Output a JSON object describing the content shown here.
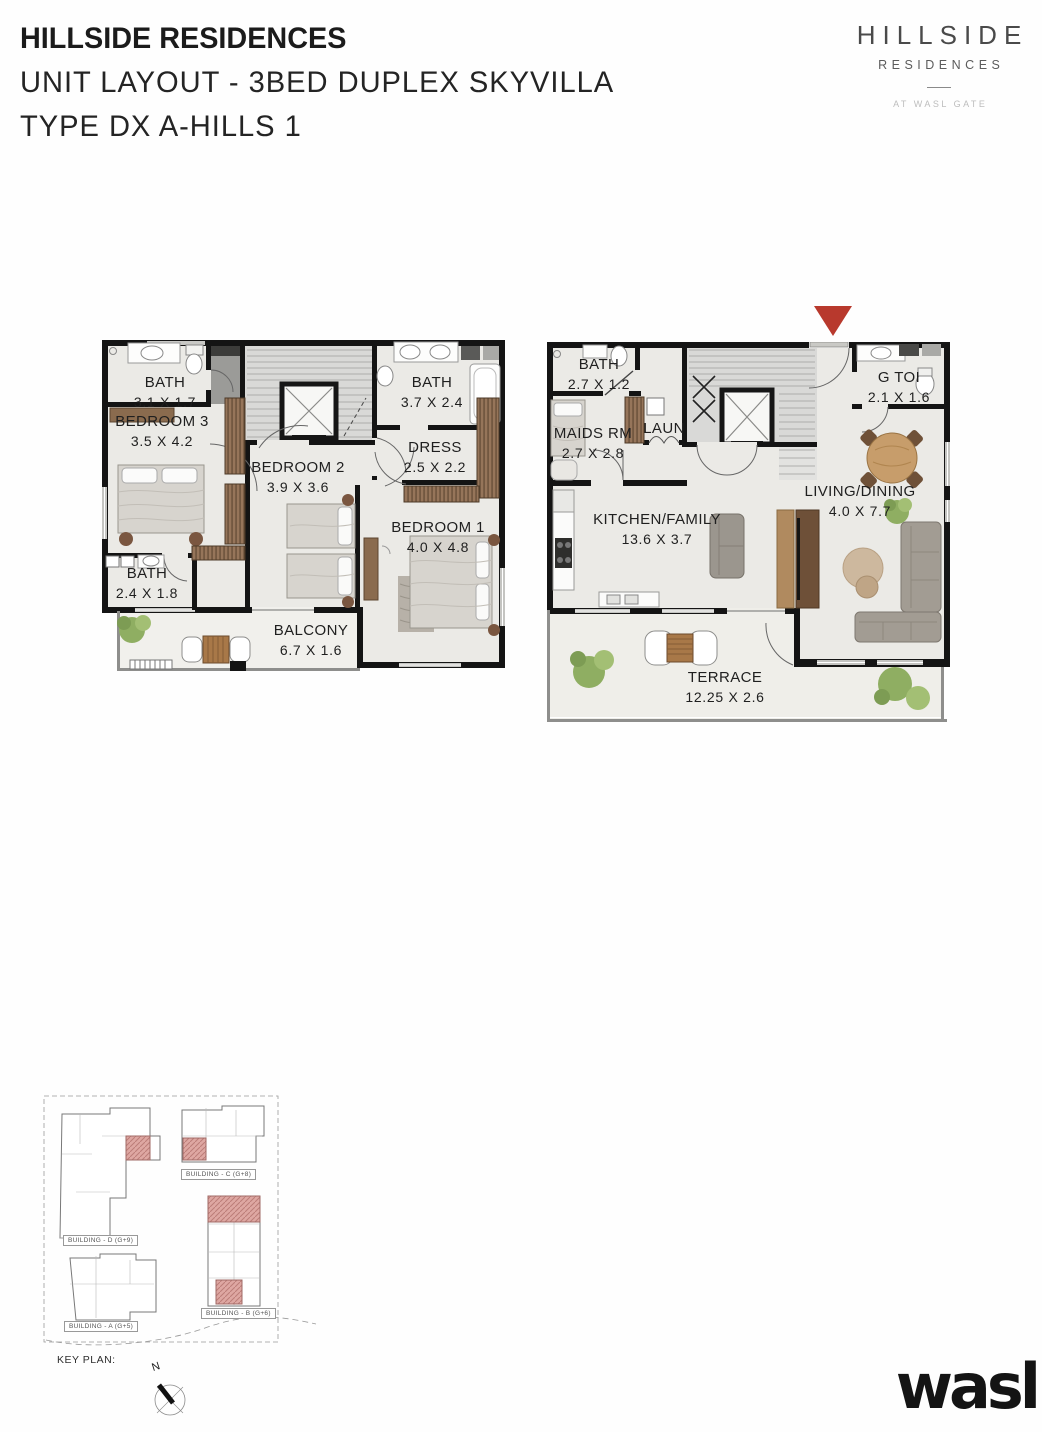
{
  "header": {
    "title": "HILLSIDE RESIDENCES",
    "subtitle": "UNIT LAYOUT - 3BED DUPLEX SKYVILLA",
    "type_line": "TYPE DX A-HILLS 1"
  },
  "brand": {
    "logo_title": "HILLSIDE",
    "logo_subtitle": "RESIDENCES",
    "logo_tagline": "AT WASL GATE",
    "wasl": "wasl"
  },
  "plans": {
    "upper": {
      "rooms": {
        "bath_a": {
          "name": "BATH",
          "dims": "3.1 X 1.7"
        },
        "bath_b": {
          "name": "BATH",
          "dims": "3.7 X 2.4"
        },
        "bedroom3": {
          "name": "BEDROOM 3",
          "dims": "3.5 X 4.2"
        },
        "dress": {
          "name": "DRESS",
          "dims": "2.5 X 2.2"
        },
        "bedroom2": {
          "name": "BEDROOM 2",
          "dims": "3.9 X 3.6"
        },
        "bedroom1": {
          "name": "BEDROOM 1",
          "dims": "4.0 X 4.8"
        },
        "bath_c": {
          "name": "BATH",
          "dims": "2.4 X 1.8"
        },
        "balcony": {
          "name": "BALCONY",
          "dims": "6.7 X 1.6"
        }
      }
    },
    "lower": {
      "rooms": {
        "bath": {
          "name": "BATH",
          "dims": "2.7 X 1.2"
        },
        "gtoi": {
          "name": "G TOI",
          "dims": "2.1 X 1.6"
        },
        "maids": {
          "name": "MAIDS RM",
          "dims": "2.7 X 2.8"
        },
        "laun": {
          "name": "LAUN",
          "dims": ""
        },
        "kitchen": {
          "name": "KITCHEN/FAMILY",
          "dims": "13.6 X 3.7"
        },
        "living": {
          "name": "LIVING/DINING",
          "dims": "4.0 X 7.7"
        },
        "terrace": {
          "name": "TERRACE",
          "dims": "12.25 X 2.6"
        }
      }
    }
  },
  "key_plan": {
    "label": "KEY PLAN:",
    "north": "N",
    "buildings": {
      "d": "BUILDING - D (G+9)",
      "c": "BUILDING - C (G+8)",
      "b": "BUILDING - B (G+6)",
      "a": "BUILDING - A (G+5)"
    }
  },
  "colors": {
    "wall": "#141414",
    "floor": "#ebeae6",
    "entrance_marker": "#b8392d",
    "wood": "#8a6b4e",
    "plant": "#8fae62",
    "keyplan_unit": "#dea7a2"
  }
}
